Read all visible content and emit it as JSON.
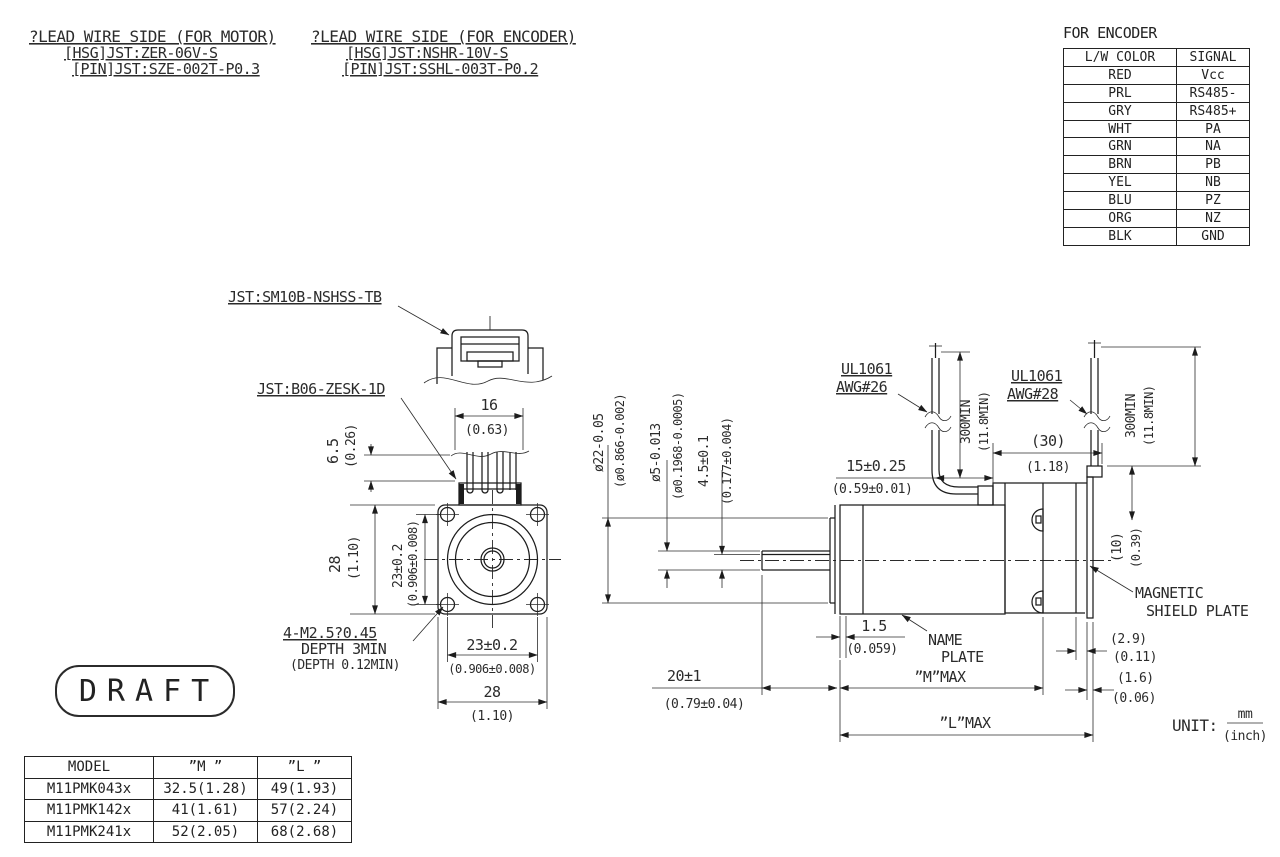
{
  "lead_motor": {
    "line1": "?LEAD WIRE SIDE (FOR MOTOR)",
    "line2": "[HSG]JST:ZER-06V-S",
    "line3": "[PIN]JST:SZE-002T-P0.3"
  },
  "lead_encoder": {
    "line1": "?LEAD WIRE SIDE (FOR ENCODER)",
    "line2": "[HSG]JST:NSHR-10V-S",
    "line3": "[PIN]JST:SSHL-003T-P0.2"
  },
  "encoder_table": {
    "title": "FOR ENCODER",
    "headers": [
      "L/W COLOR",
      "SIGNAL"
    ],
    "rows": [
      [
        "RED",
        "Vcc"
      ],
      [
        "PRL",
        "RS485-"
      ],
      [
        "GRY",
        "RS485+"
      ],
      [
        "WHT",
        "PA"
      ],
      [
        "GRN",
        "NA"
      ],
      [
        "BRN",
        "PB"
      ],
      [
        "YEL",
        "NB"
      ],
      [
        "BLU",
        "PZ"
      ],
      [
        "ORG",
        "NZ"
      ],
      [
        "BLK",
        "GND"
      ]
    ]
  },
  "model_table": {
    "headers": [
      "MODEL",
      "”M ”",
      "”L ”"
    ],
    "rows": [
      [
        "M11PMK043x",
        "32.5(1.28)",
        "49(1.93)"
      ],
      [
        "M11PMK142x",
        "41(1.61)",
        "57(2.24)"
      ],
      [
        "M11PMK241x",
        "52(2.05)",
        "68(2.68)"
      ]
    ]
  },
  "stamp": "DRAFT",
  "unit": {
    "label": "UNIT:",
    "mm": "mm",
    "inch": "(inch)"
  },
  "callouts": {
    "conn_encoder": "JST:SM10B-NSHSS-TB",
    "conn_motor": "JST:B06-ZESK-1D",
    "tap1": "4-M2.5?0.45",
    "tap2": "DEPTH 3MIN",
    "tap3": "(DEPTH 0.12MIN)",
    "ul1061": "UL1061",
    "awg26": "AWG#26",
    "awg28": "AWG#28",
    "magnetic1": "MAGNETIC",
    "magnetic2": "SHIELD PLATE",
    "nameplate1": "NAME",
    "nameplate2": "PLATE",
    "mmax": "”M”MAX",
    "lmax": "”L”MAX"
  },
  "dims": {
    "d16": "16",
    "d16i": "(0.63)",
    "d65": "6.5",
    "d65i": "(0.26)",
    "d28": "28",
    "d28i": "(1.10)",
    "d23": "23±0.2",
    "d23i": "(0.906±0.008)",
    "dia22": "ø22-0.05",
    "dia22i": "(ø0.866-0.002)",
    "dia5": "ø5-0.013",
    "dia5i": "(ø0.1968-0.0005)",
    "d45": "4.5±0.1",
    "d45i": "(0.177±0.004)",
    "d15": "15±0.25",
    "d15i": "(0.59±0.01)",
    "d30": "(30)",
    "d30i": "(1.18)",
    "d300": "300MIN",
    "d300i": "(11.8MIN)",
    "d10": "(10)",
    "d10i": "(0.39)",
    "d15n": "1.5",
    "d15ni": "(0.059)",
    "d20": "20±1",
    "d20i": "(0.79±0.04)",
    "d29": "(2.9)",
    "d29i": "(0.11)",
    "d16r": "(1.6)",
    "d16ri": "(0.06)"
  }
}
